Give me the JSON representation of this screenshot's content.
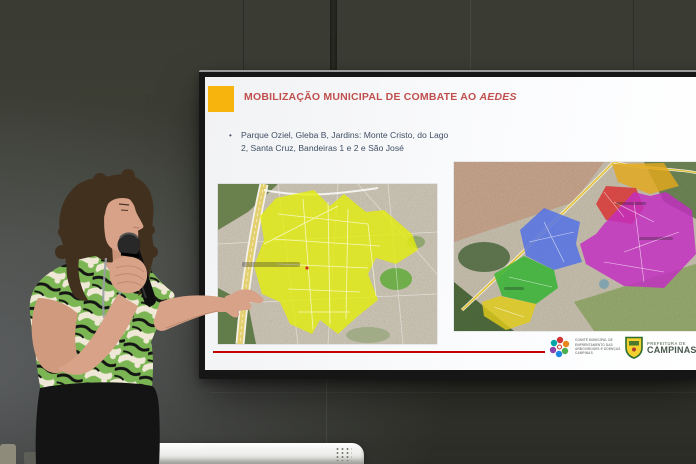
{
  "slide": {
    "title": {
      "prefix": "MOBILIZAÇÃO MUNICIPAL DE COMBATE AO ",
      "emphasis": "AEDES"
    },
    "title_color": "#C0504D",
    "accent_color": "#F6B40C",
    "bullet_marker": "•",
    "bullet_text": "Parque Oziel, Gleba B, Jardins: Monte Cristo, do Lago 2, Santa Cruz, Bandeiras 1 e 2 e São José",
    "footer_line_color": "#C40000",
    "logos": {
      "committee": {
        "lines": [
          "COMITÊ MUNICIPAL DE",
          "ENFRENTAMENTO DAS",
          "ARBOVIROSES E DOENÇAS",
          "CAMPINAS"
        ]
      },
      "city": {
        "small": "PREFEITURA DE",
        "name": "CAMPINAS"
      }
    },
    "maps": {
      "left": {
        "type": "satellite",
        "highlight": {
          "name": "area-destacada-amarela",
          "color": "#E4EE08"
        }
      },
      "right": {
        "type": "satellite",
        "zones": [
          {
            "name": "zona-amarela-norte",
            "color": "#E3A81C"
          },
          {
            "name": "zona-vermelha",
            "color": "#D92F2F"
          },
          {
            "name": "zona-magenta",
            "color": "#C32CC3"
          },
          {
            "name": "zona-azul",
            "color": "#4F6FE8"
          },
          {
            "name": "zona-verde",
            "color": "#2FB32F"
          },
          {
            "name": "zona-amarela-sul",
            "color": "#E0CC1A"
          }
        ]
      }
    }
  },
  "scene_colors": {
    "wall": "#3B3D34",
    "bezel": "#161616",
    "slide_bg": "#F8F9FB"
  }
}
